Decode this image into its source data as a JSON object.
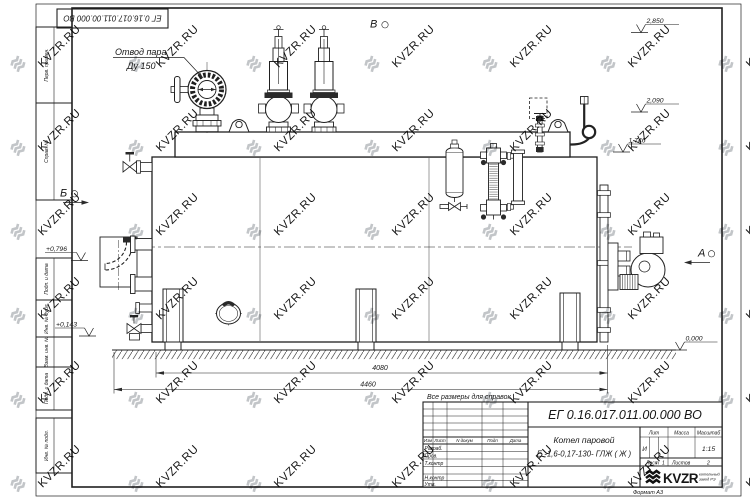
{
  "watermark": {
    "text": "KVZR.RU"
  },
  "sheet": {
    "top_stamp": "ЕГ 0.16.017.011.00.000  ВО",
    "format_note": "Формат А3",
    "margin_fields": [
      "Перв. примен.",
      "Справ. №",
      "Подп. и дата",
      "Инв. № дубл.",
      "Взам. инв. №",
      "Подп. и дата",
      "Инв. № подл."
    ]
  },
  "drawing": {
    "callout_steam_line1": "Отвод пара",
    "callout_steam_line2": "Ду 150",
    "view_top": "В",
    "view_left": "Б",
    "view_right": "А",
    "levels": {
      "l2850": "2,850",
      "l2090": "2,090",
      "l1746": "1,746",
      "l0000": "0,000",
      "l0796": "+0,796",
      "l0143": "+0,143"
    },
    "dim_4080": "4080",
    "dim_4460": "4460",
    "note": "Все размеры для справок"
  },
  "title_block": {
    "doc_number": "ЕГ 0.16.017.011.00.000  ВО",
    "name_line1": "Котел паровой",
    "name_line2": "Е -1,6-0,17-130- ГЛЖ ( Ж )",
    "col_izm": "Изм",
    "col_list": "Лист",
    "col_ndokum": "N докум",
    "col_podp": "Подп",
    "col_data": "Дата",
    "row_razrab": "Разраб.",
    "row_prov": "Пров.",
    "row_tkontr": "Т.контр",
    "row_nkontr": "Н.контр",
    "row_utv": "Утв.",
    "lit_label": "Лит",
    "mass_label": "Масса",
    "scale_label": "Масштаб",
    "lit_value": "И",
    "scale_value": "1:15",
    "sheet_label": "Лист",
    "sheet_value": "1",
    "sheets_label": "Листов",
    "sheets_value": "2",
    "logo_text": "KVZR",
    "logo_sub_line1": "котельный",
    "logo_sub_line2": "завод РЭ"
  }
}
